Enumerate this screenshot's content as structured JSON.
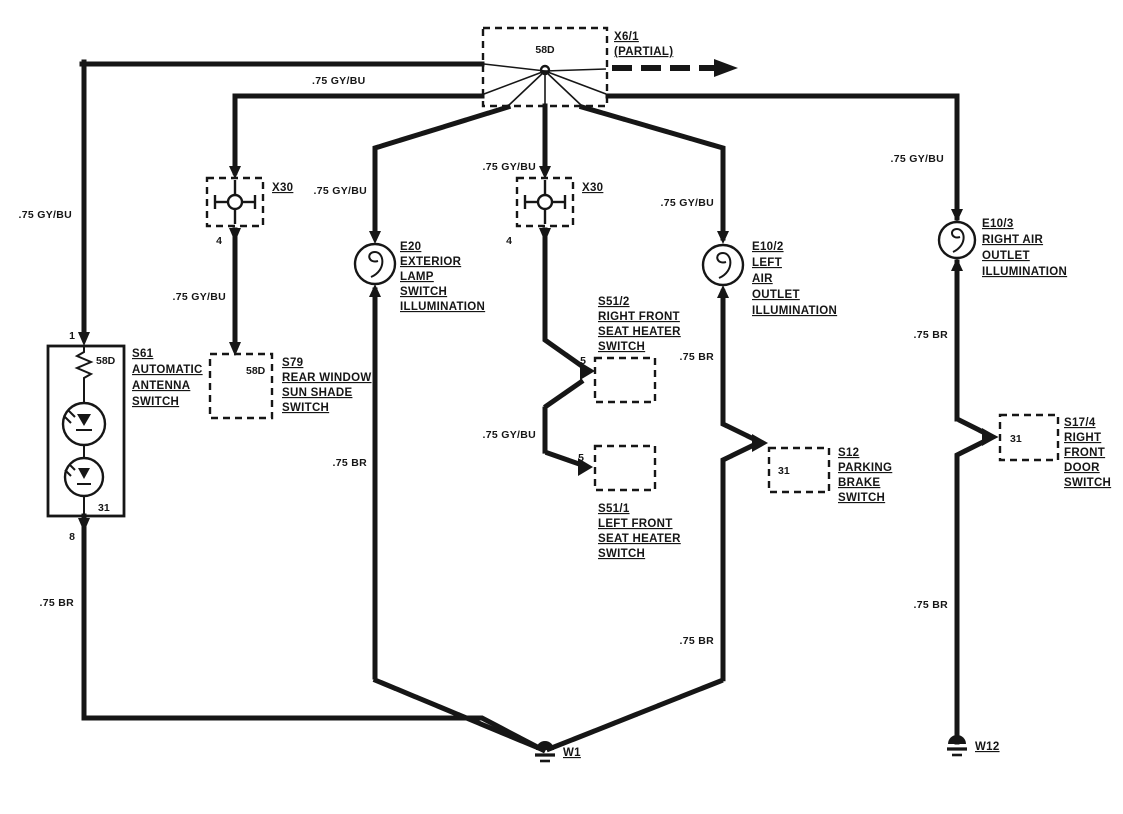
{
  "colors": {
    "ink": "#161616",
    "paper": "#ffffff"
  },
  "wire_labels": {
    "gy_bu": ".75 GY/BU",
    "br": ".75 BR"
  },
  "hub": {
    "terminal": "58D"
  },
  "x6_1": {
    "id": "X6/1",
    "note": "(PARTIAL)"
  },
  "x30_left": {
    "id": "X30",
    "pin": "4"
  },
  "x30_center": {
    "id": "X30",
    "pin": "4"
  },
  "s61": {
    "id": "S61",
    "name": [
      "AUTOMATIC",
      "ANTENNA",
      "SWITCH"
    ],
    "pin_top": "1",
    "pin_bottom": "8",
    "terminal_top": "58D",
    "terminal_bottom": "31"
  },
  "s79": {
    "id": "S79",
    "name": [
      "REAR WINDOW",
      "SUN SHADE",
      "SWITCH"
    ],
    "terminal": "58D"
  },
  "e20": {
    "id": "E20",
    "name": [
      "EXTERIOR",
      "LAMP",
      "SWITCH",
      "ILLUMINATION"
    ]
  },
  "s51_2": {
    "id": "S51/2",
    "name": [
      "RIGHT FRONT",
      "SEAT HEATER",
      "SWITCH"
    ],
    "pin": "5"
  },
  "s51_1": {
    "id": "S51/1",
    "name": [
      "LEFT FRONT",
      "SEAT HEATER",
      "SWITCH"
    ],
    "pin": "5"
  },
  "e10_2": {
    "id": "E10/2",
    "name": [
      "LEFT",
      "AIR",
      "OUTLET",
      "ILLUMINATION"
    ]
  },
  "e10_3": {
    "id": "E10/3",
    "name": [
      "RIGHT AIR",
      "OUTLET",
      "ILLUMINATION"
    ]
  },
  "s12": {
    "id": "S12",
    "name": [
      "PARKING",
      "BRAKE",
      "SWITCH"
    ],
    "terminal": "31"
  },
  "s17_4": {
    "id": "S17/4",
    "name": [
      "RIGHT",
      "FRONT",
      "DOOR",
      "SWITCH"
    ],
    "terminal": "31"
  },
  "grounds": {
    "w1": "W1",
    "w12": "W12"
  }
}
